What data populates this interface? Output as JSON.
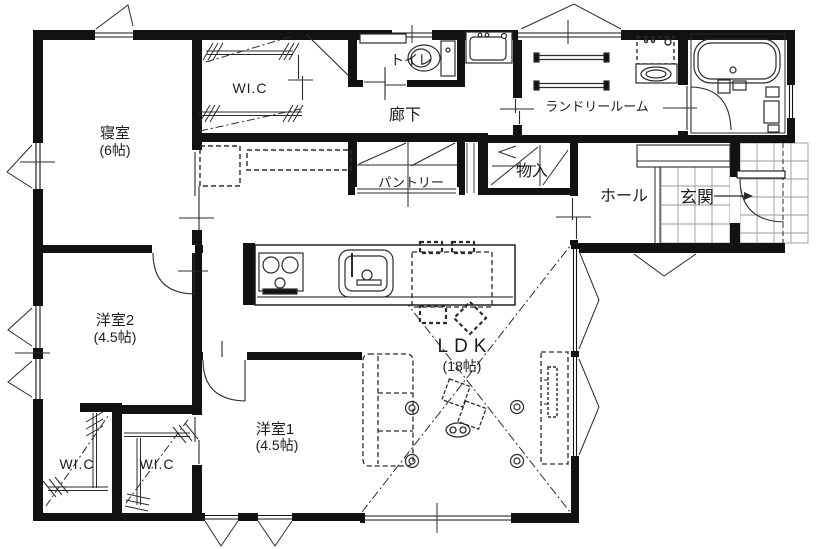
{
  "floor_plan": {
    "wall_color": "#121212",
    "line_color": "#2b2b2b",
    "tile_color": "#9a9a9a",
    "labels": {
      "bedroom": "寝室",
      "bedroom_size": "(6帖)",
      "wic_north": "WI.C",
      "toilet": "トイレ",
      "hallway": "廊下",
      "laundry": "ランドリールーム",
      "pantry": "パントリー",
      "storage": "物入",
      "hall": "ホール",
      "entrance": "玄関",
      "western2": "洋室2",
      "western2_size": "(4.5帖)",
      "western1": "洋室1",
      "western1_size": "(4.5帖)",
      "wic_west": "WI.C",
      "wic_mid": "WI.C",
      "ldk": "LDK",
      "ldk_size": "(18帖)"
    }
  }
}
